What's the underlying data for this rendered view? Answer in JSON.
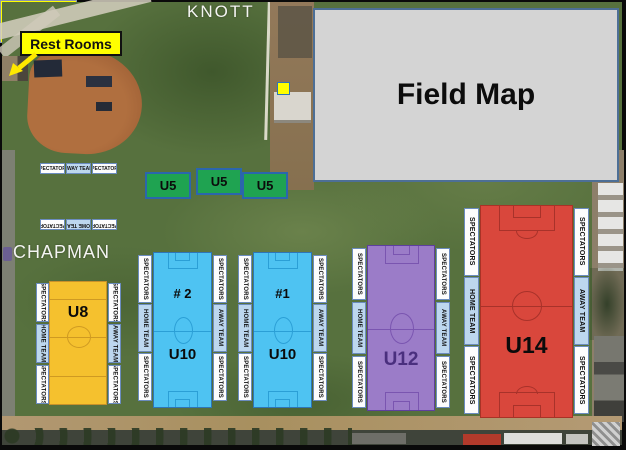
{
  "scene": {
    "street_top": "KNOTT",
    "street_left": "CHAPMAN",
    "legend_title": "Field Map",
    "restrooms": "Rest Rooms"
  },
  "labels": {
    "spectators": "SPECTATORS",
    "home_team": "HOME TEAM",
    "away_team": "AWAY TEAM"
  },
  "fields": {
    "u6": {
      "name": "U6",
      "color": "#FFFF00"
    },
    "u5": [
      {
        "name": "U5",
        "color": "#1FA351"
      },
      {
        "name": "U5",
        "color": "#1FA351"
      },
      {
        "name": "U5",
        "color": "#1FA351"
      }
    ],
    "u8": {
      "name": "U8",
      "color": "#F5C12E"
    },
    "u10_2": {
      "number": "# 2",
      "name": "U10",
      "color": "#4EC3F2"
    },
    "u10_1": {
      "number": "#1",
      "name": "U10",
      "color": "#4EC3F2"
    },
    "u12": {
      "name": "U12",
      "color": "#9B7CC8",
      "text_color": "#4A2F7E"
    },
    "u14": {
      "name": "U14",
      "color": "#D9473C"
    }
  },
  "icons": {
    "restrooms_arrow": "arrow-down-left-icon",
    "marker_square": "yellow-field-marker"
  }
}
